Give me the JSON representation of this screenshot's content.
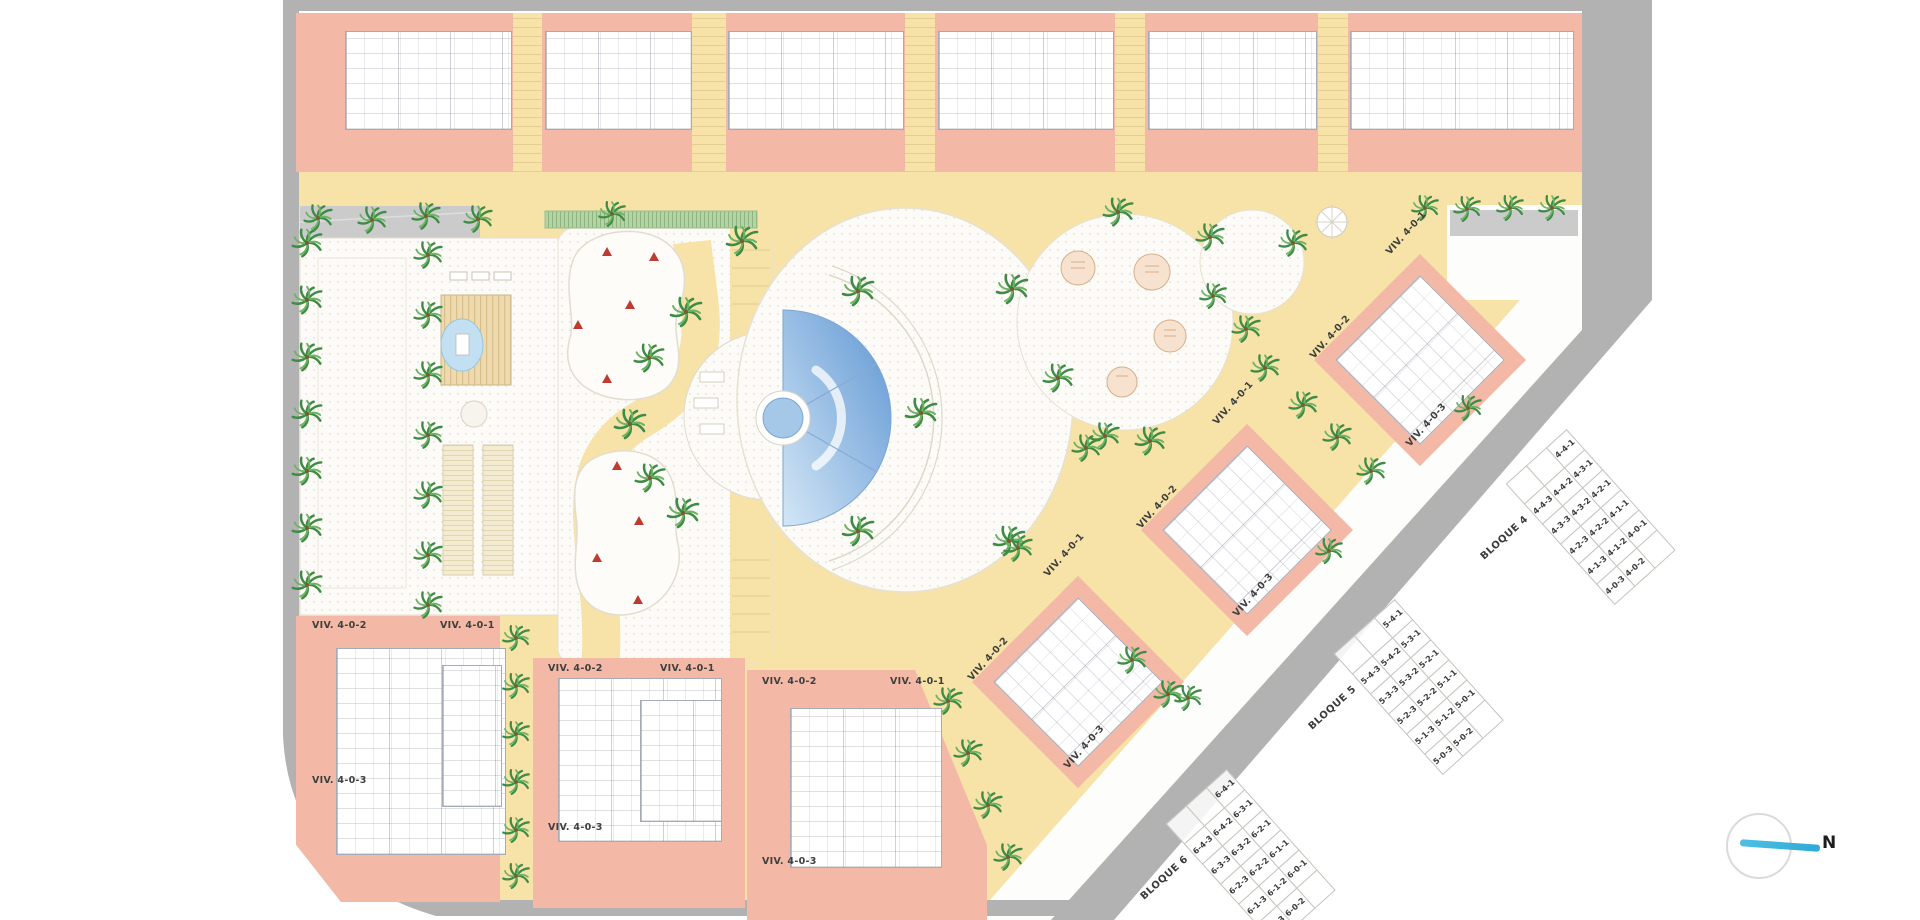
{
  "north": {
    "label": "N"
  },
  "buildings": [
    {
      "id": "bottom-1",
      "labels": [
        "VIV. 4-0-2",
        "VIV. 4-0-1",
        "VIV. 4-0-3"
      ]
    },
    {
      "id": "bottom-2",
      "labels": [
        "VIV. 4-0-2",
        "VIV. 4-0-1",
        "VIV. 4-0-3"
      ]
    },
    {
      "id": "bottom-3",
      "labels": [
        "VIV. 4-0-2",
        "VIV. 4-0-1",
        "VIV. 4-0-3"
      ]
    },
    {
      "id": "diagonal-1",
      "labels": [
        "VIV. 4-0-1",
        "VIV. 4-0-2",
        "VIV. 4-0-3"
      ]
    },
    {
      "id": "diagonal-2",
      "labels": [
        "VIV. 4-0-1",
        "VIV. 4-0-2",
        "VIV. 4-0-3"
      ]
    },
    {
      "id": "diagonal-3",
      "labels": [
        "VIV. 4-0-1",
        "VIV. 4-0-2",
        "VIV. 4-0-3"
      ]
    }
  ],
  "bloques": [
    {
      "name": "BLOQUE 4",
      "rows": [
        [
          "",
          "",
          "4-4-1"
        ],
        [
          "4-4-3",
          "4-4-2",
          "4-3-1"
        ],
        [
          "4-3-3",
          "4-3-2",
          "4-2-1"
        ],
        [
          "4-2-3",
          "4-2-2",
          "4-1-1"
        ],
        [
          "4-1-3",
          "4-1-2",
          "4-0-1"
        ],
        [
          "4-0-3",
          "4-0-2",
          ""
        ]
      ]
    },
    {
      "name": "BLOQUE 5",
      "rows": [
        [
          "",
          "",
          "5-4-1"
        ],
        [
          "5-4-3",
          "5-4-2",
          "5-3-1"
        ],
        [
          "5-3-3",
          "5-3-2",
          "5-2-1"
        ],
        [
          "5-2-3",
          "5-2-2",
          "5-1-1"
        ],
        [
          "5-1-3",
          "5-1-2",
          "5-0-1"
        ],
        [
          "5-0-3",
          "5-0-2",
          ""
        ]
      ]
    },
    {
      "name": "BLOQUE 6",
      "rows": [
        [
          "",
          "",
          "6-4-1"
        ],
        [
          "6-4-3",
          "6-4-2",
          "6-3-1"
        ],
        [
          "6-3-3",
          "6-3-2",
          "6-2-1"
        ],
        [
          "6-2-3",
          "6-2-2",
          "6-1-1"
        ],
        [
          "6-1-3",
          "6-1-2",
          "6-0-1"
        ],
        [
          "6-0-3",
          "6-0-2",
          ""
        ]
      ]
    }
  ],
  "colors": {
    "building_salmon": "#f3b9a6",
    "path_yellow": "#f7e2a8",
    "road_gray": "#b2b2b2",
    "sidewalk_gray": "#cbcbcb",
    "pool_blue": "#5f97d3",
    "palm_green": "#3e8b46",
    "play_red": "#bf3a31",
    "north_cyan": "#3ab7de"
  }
}
